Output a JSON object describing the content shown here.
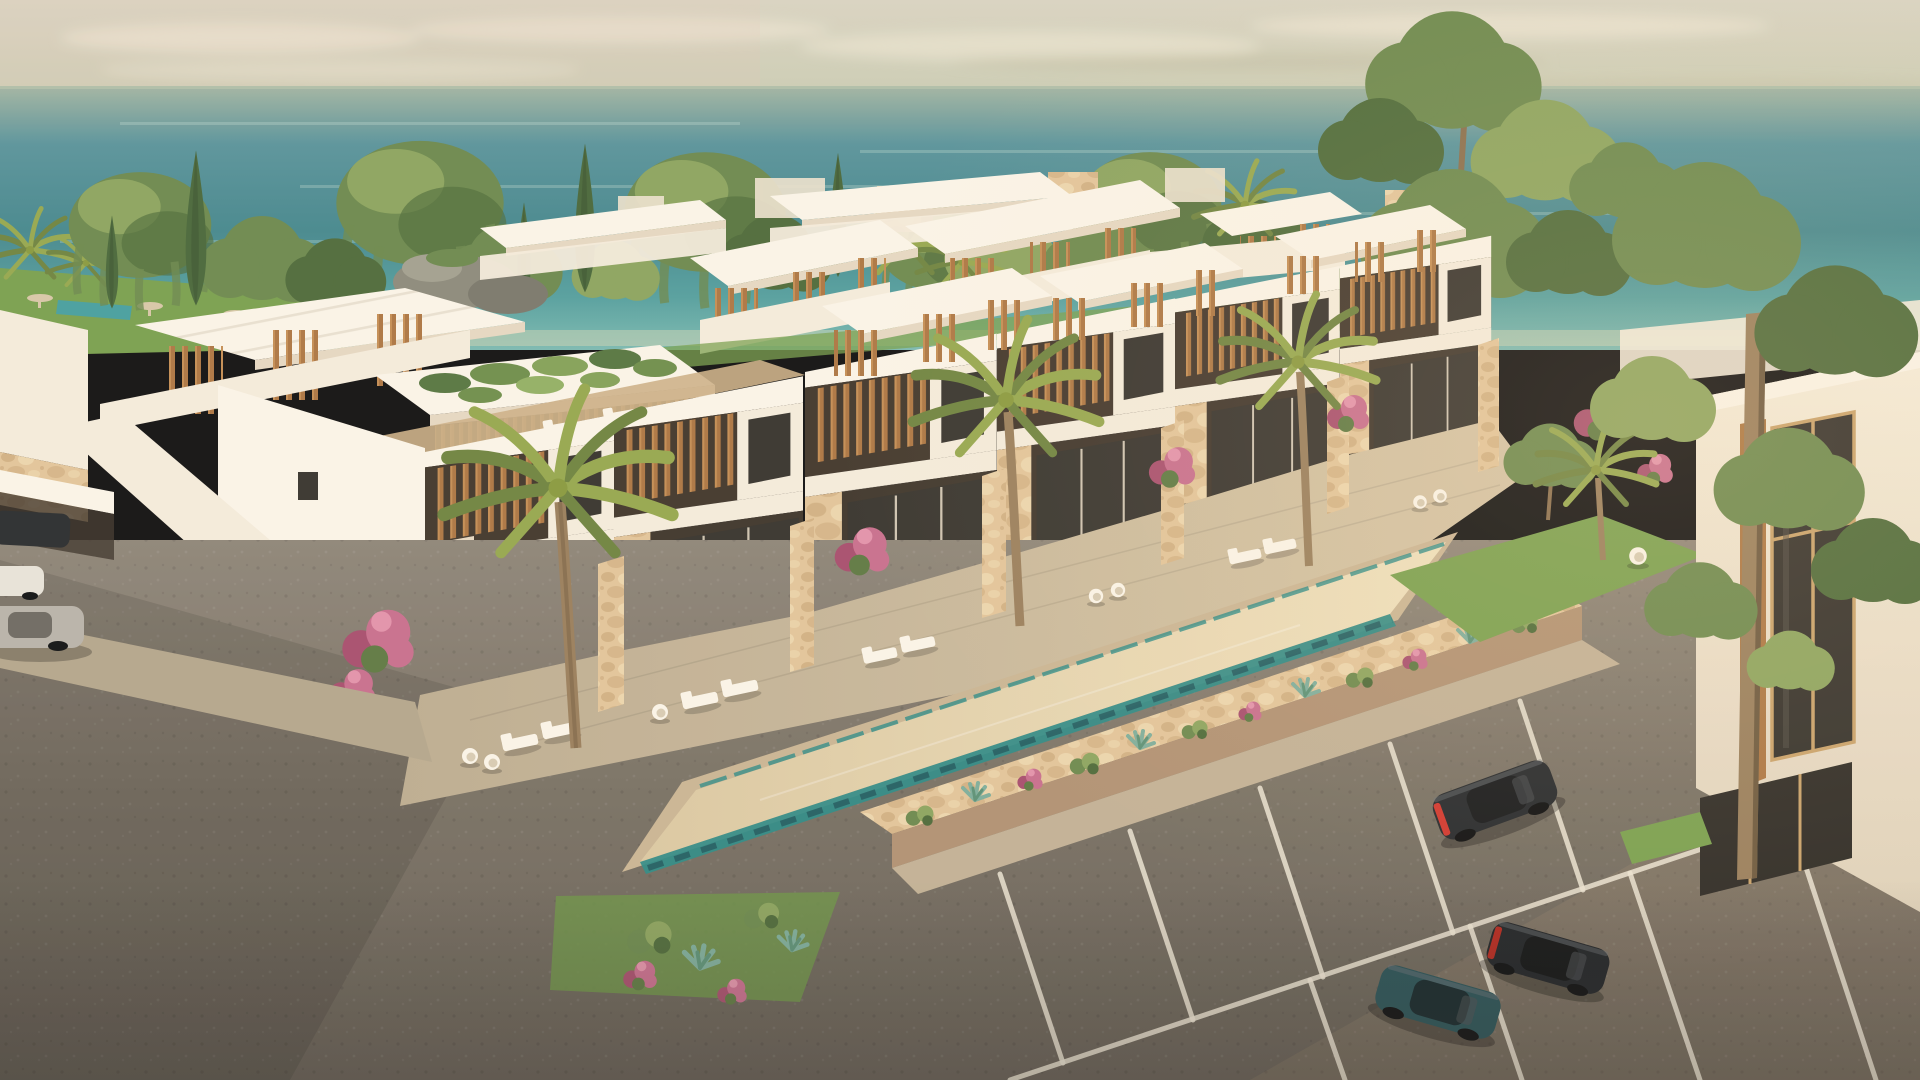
{
  "scene": {
    "subject": "Aerial 3D architectural rendering of a modern white seafront villa complex at golden hour",
    "elements": [
      "hazy-warm-sky",
      "soft-clouds",
      "teal-sea-horizon",
      "tree-line-willows-cypresses-palms",
      "rock-formation",
      "lawn-park-with-small-pool-and-umbrellas",
      "rear-villa-row-with-rooftop-pergolas",
      "stone-chimney-blocks",
      "green-roof-terrace",
      "roof-deck-with-wood-floor",
      "exterior-staircase",
      "front-villa-row-two-storey",
      "wood-slat-balcony-screens",
      "stone-clad-ground-floor",
      "private-patios-with-loungers-and-egg-chairs",
      "stone-partition-walls",
      "bougainvillea-shrubs",
      "coconut-palm-trees",
      "long-sand-bottom-pool-with-teal-edge",
      "planted-stone-perimeter-wall",
      "succulents-and-agaves",
      "sidewalk",
      "asphalt-parking-lot",
      "white-parking-stripes",
      "dark-sports-coupe",
      "black-sports-car",
      "teal-sports-car",
      "carport-with-three-cars",
      "right-side-building-with-tall-window",
      "tall-foreground-tree",
      "warm-sunset-glow"
    ],
    "counts": {
      "front_row_villas": 6,
      "rear_row_blocks": 5,
      "rooftop_pergolas": 9,
      "foreground_palm_trees": 4,
      "parking_cars": 3,
      "carport_cars": 3,
      "pools": 2,
      "staircases": 1,
      "green_roof_terraces": 1
    }
  },
  "palette": {
    "sky-top": "#dad4c2",
    "sky-low": "#c3c7ae",
    "cloud": "#ece6d3",
    "ocean-haze": "#a3b5a3",
    "ocean-deep": "#45888e",
    "ocean-mid": "#55a09f",
    "ocean-light": "#7cbab1",
    "tree-dark": "#4e6b3a",
    "tree-mid": "#6d8a4e",
    "tree-light": "#8da55f",
    "cypress": "#49683a",
    "palm": "#96a84f",
    "palm-dark": "#6f8440",
    "grass": "#7aa14f",
    "rock": "#8d8b7c",
    "white-bright": "#fbf5e8",
    "white-sun": "#f5ecdc",
    "white-shade": "#e6d8c2",
    "white-dim": "#d6c7af",
    "wood": "#ad7743",
    "wood-light": "#c58e54",
    "wood-dark": "#6e4c2b",
    "stone": "#e3c69a",
    "stone-dark": "#c5a273",
    "stone-shade": "#b29273",
    "glass": "#37342e",
    "patio": "#c9b99d",
    "patio-shade": "#b0a189",
    "pool-sand": "#e6d4af",
    "pool-teal": "#2e8c87",
    "pool-navy": "#1d4f57",
    "road-light": "#8f8679",
    "road-dark": "#665f55",
    "stripe": "#ece4d2",
    "flower-pink": "#c96f8e",
    "flower-deep": "#a84f6e",
    "trunk": "#9a7f5c",
    "car-dark": "#26292c",
    "car-teal": "#2a5257",
    "tail-red": "#d2382e"
  }
}
